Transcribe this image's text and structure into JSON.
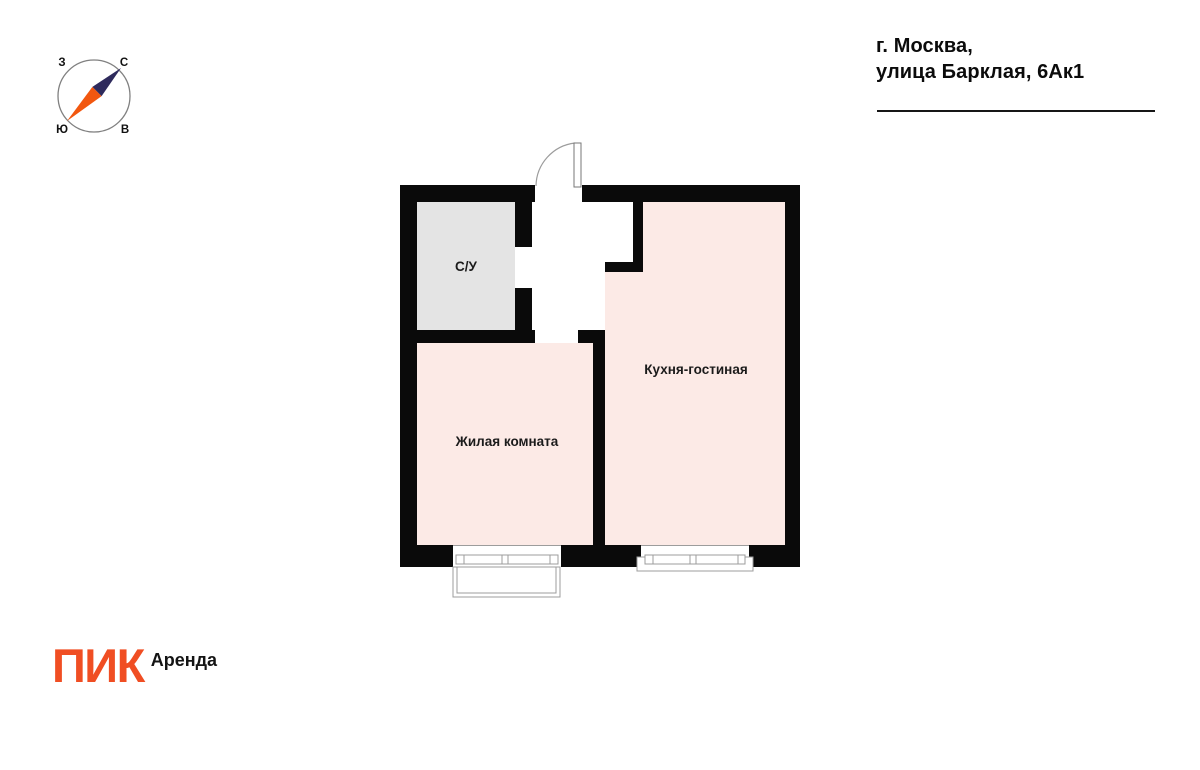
{
  "compass": {
    "west": "З",
    "north": "С",
    "south": "Ю",
    "east": "В"
  },
  "address": {
    "line1": "г. Москва,",
    "line2": "улица Барклая, 6Ак1"
  },
  "rooms": {
    "bathroom": {
      "label": "С/У"
    },
    "living": {
      "label": "Жилая комната"
    },
    "kitchen": {
      "label": "Кухня-гостиная"
    }
  },
  "brand": {
    "logo": "ПИК",
    "product": "Аренда"
  },
  "colors": {
    "wall": "#0a0a0a",
    "room_fill": "#fceae6",
    "bathroom_fill": "#e4e4e4",
    "brand_orange": "#f04e23",
    "needle_north": "#2e2a5c",
    "needle_south": "#f2570f",
    "line_gray": "#9c9c9c",
    "circle_gray": "#808080"
  }
}
